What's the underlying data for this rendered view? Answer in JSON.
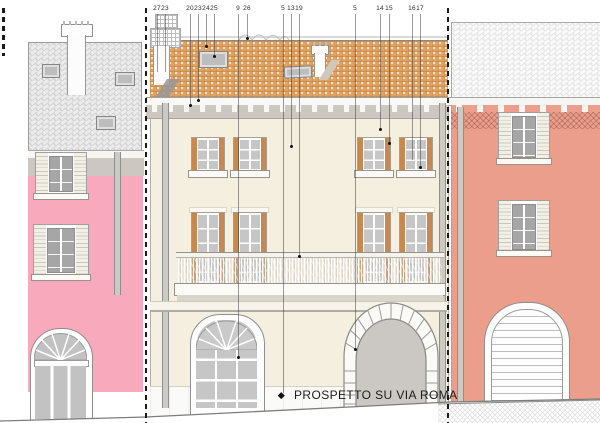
{
  "title": {
    "label": "PROSPETTO SU VIA ROMA"
  },
  "annotations": {
    "items": [
      {
        "label": "27"
      },
      {
        "label": "23"
      },
      {
        "label": "20"
      },
      {
        "label": "23"
      },
      {
        "label": "24"
      },
      {
        "label": "25"
      },
      {
        "label": "9"
      },
      {
        "label": "26"
      },
      {
        "label": "5"
      },
      {
        "label": "13"
      },
      {
        "label": "19"
      },
      {
        "label": "5"
      },
      {
        "label": "14"
      },
      {
        "label": "15"
      },
      {
        "label": "16"
      },
      {
        "label": "17"
      }
    ]
  },
  "colors": {
    "roof_tile": "#e2a25f",
    "left_roof": "#ececec",
    "right_roof": "#fafafa",
    "facade": "#f4efde",
    "left_wall": "#f8a9bc",
    "right_wall": "#eb9e8c",
    "shutter": "#c9884e",
    "glass": "#c6c6c6",
    "cornice": "#ccc8c1",
    "outline": "#8e8e8e"
  }
}
